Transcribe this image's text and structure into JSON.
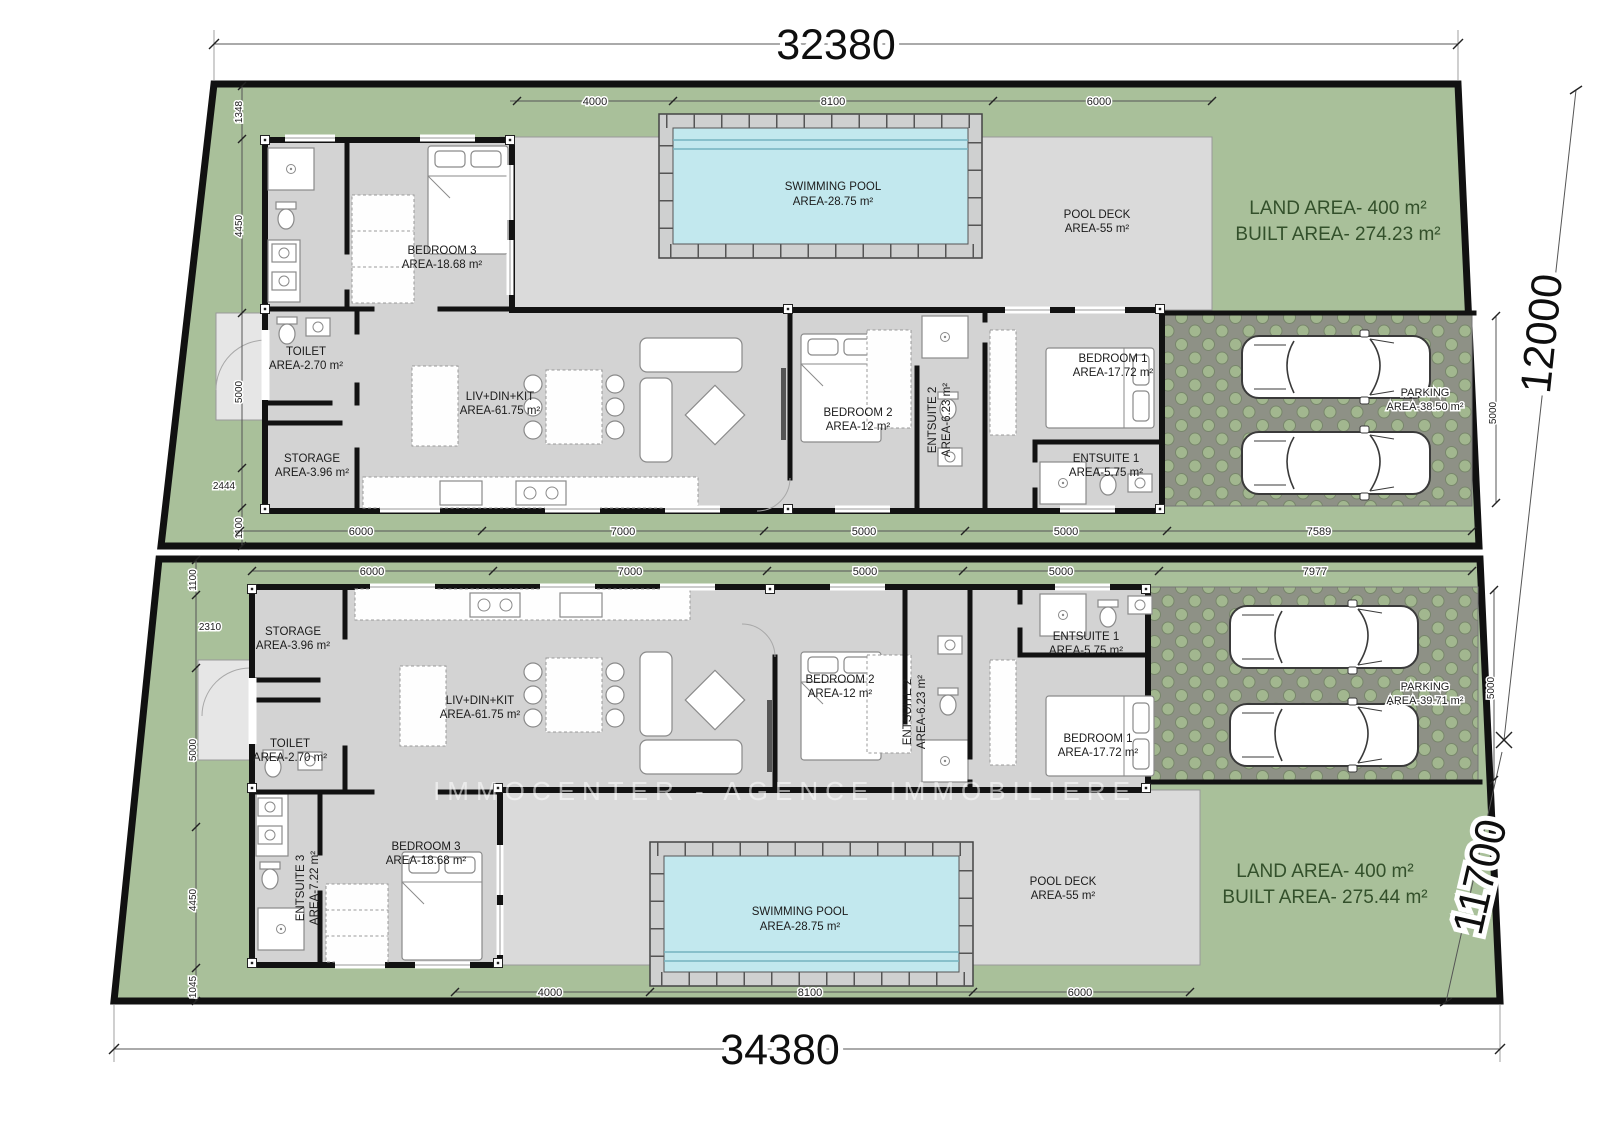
{
  "watermark": "IMMOCENTER - AGENCE IMMOBILIERE",
  "site": {
    "top_width": "32380",
    "bottom_width": "34380",
    "height_a": "12000",
    "height_b": "11700"
  },
  "unit_a": {
    "land_area": "LAND AREA- 400 m²",
    "built_area": "BUILT AREA- 274.23 m²",
    "rooms": {
      "bedroom3": {
        "name": "BEDROOM 3",
        "area": "AREA-18.68 m²"
      },
      "toilet": {
        "name": "TOILET",
        "area": "AREA-2.70 m²"
      },
      "storage": {
        "name": "STORAGE",
        "area": "AREA-3.96 m²"
      },
      "livdinkit": {
        "name": "LIV+DIN+KIT",
        "area": "AREA-61.75 m²"
      },
      "bedroom2": {
        "name": "BEDROOM 2",
        "area": "AREA-12 m²"
      },
      "entsuite2": {
        "name": "ENTSUITE 2",
        "area": "AREA-6.23 m²"
      },
      "bedroom1": {
        "name": "BEDROOM 1",
        "area": "AREA-17.72 m²"
      },
      "entsuite1": {
        "name": "ENTSUITE 1",
        "area": "AREA-5.75 m²"
      },
      "pool": {
        "name": "SWIMMING POOL",
        "area": "AREA-28.75 m²"
      },
      "pooldeck": {
        "name": "POOL DECK",
        "area": "AREA-55 m²"
      },
      "parking": {
        "name": "PARKING",
        "area": "AREA-38.50 m²"
      }
    },
    "dims": {
      "top": [
        "4000",
        "8100",
        "6000"
      ],
      "bottom": [
        "6000",
        "7000",
        "5000",
        "5000",
        "7589"
      ],
      "left": [
        "1348",
        "4450",
        "5000",
        "2444",
        "1100"
      ],
      "parking_side": "5000"
    }
  },
  "unit_b": {
    "land_area": "LAND AREA- 400 m²",
    "built_area": "BUILT AREA- 275.44 m²",
    "rooms": {
      "storage": {
        "name": "STORAGE",
        "area": "AREA-3.96 m²"
      },
      "toilet": {
        "name": "TOILET",
        "area": "AREA-2.70 m²"
      },
      "livdinkit": {
        "name": "LIV+DIN+KIT",
        "area": "AREA-61.75 m²"
      },
      "bedroom2": {
        "name": "BEDROOM 2",
        "area": "AREA-12 m²"
      },
      "entsuite2": {
        "name": "ENTSUITE 2",
        "area": "AREA-6.23 m²"
      },
      "entsuite1": {
        "name": "ENTSUITE 1",
        "area": "AREA-5.75 m²"
      },
      "bedroom1": {
        "name": "BEDROOM 1",
        "area": "AREA-17.72 m²"
      },
      "entsuite3": {
        "name": "ENTSUITE 3",
        "area": "AREA-7.22 m²"
      },
      "bedroom3": {
        "name": "BEDROOM 3",
        "area": "AREA-18.68 m²"
      },
      "pool": {
        "name": "SWIMMING POOL",
        "area": "AREA-28.75 m²"
      },
      "pooldeck": {
        "name": "POOL DECK",
        "area": "AREA-55 m²"
      },
      "parking": {
        "name": "PARKING",
        "area": "AREA-39.71 m²"
      }
    },
    "dims": {
      "top": [
        "6000",
        "7000",
        "5000",
        "5000",
        "7977"
      ],
      "bottom": [
        "4000",
        "8100",
        "6000"
      ],
      "left": [
        "1100",
        "2310",
        "5000",
        "4450",
        "1045"
      ],
      "parking_side": "5000"
    }
  }
}
